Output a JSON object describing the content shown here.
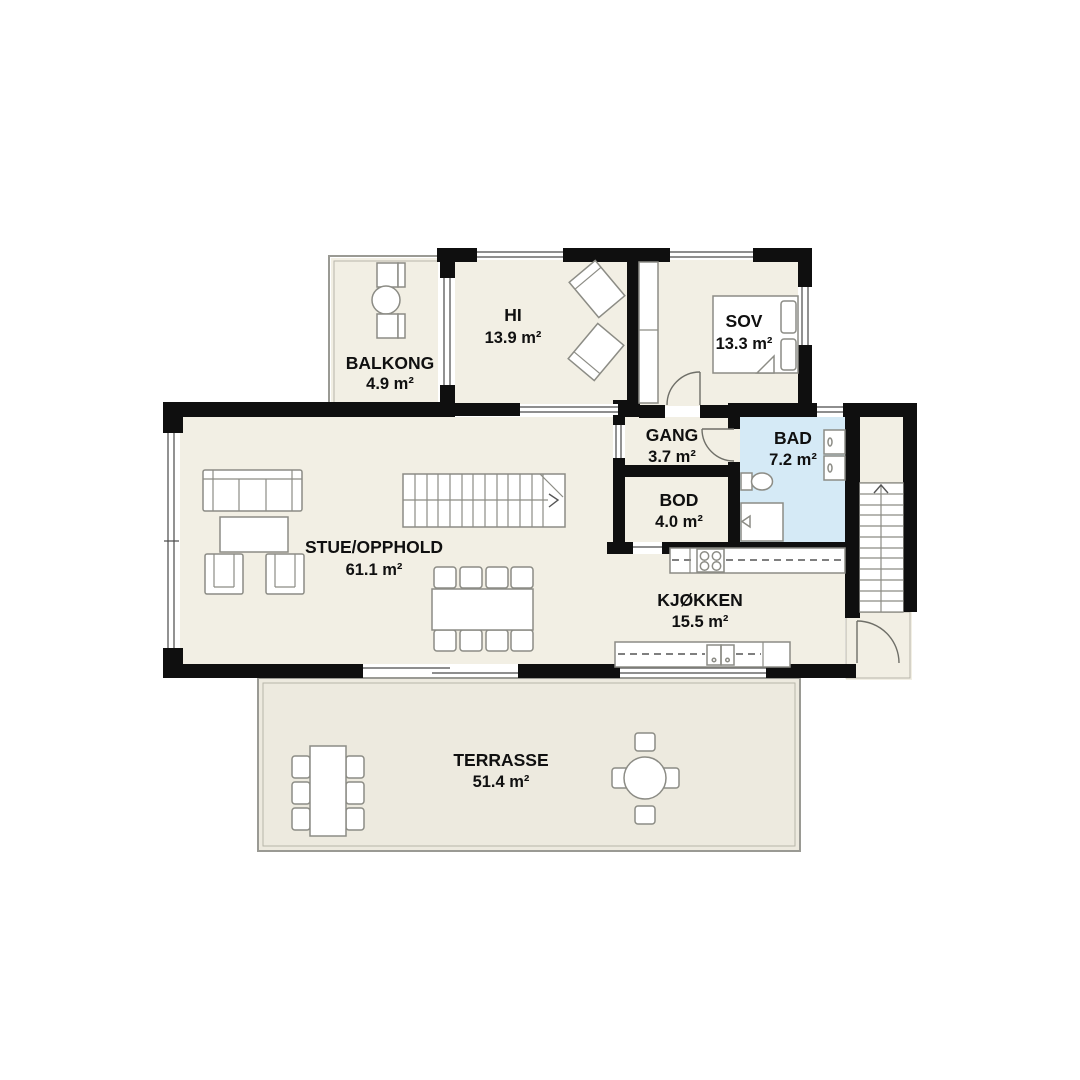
{
  "plan": {
    "type": "floor-plan",
    "language": "Norwegian",
    "rooms": [
      {
        "id": "balkong",
        "name": "BALKONG",
        "area": "4.9 m²"
      },
      {
        "id": "hi",
        "name": "HI",
        "area": "13.9 m²"
      },
      {
        "id": "sov",
        "name": "SOV",
        "area": "13.3 m²"
      },
      {
        "id": "gang",
        "name": "GANG",
        "area": "3.7 m²"
      },
      {
        "id": "bad",
        "name": "BAD",
        "area": "7.2 m²"
      },
      {
        "id": "bod",
        "name": "BOD",
        "area": "4.0 m²"
      },
      {
        "id": "stue",
        "name": "STUE/OPPHOLD",
        "area": "61.1 m²"
      },
      {
        "id": "kjokken",
        "name": "KJØKKEN",
        "area": "15.5 m²"
      },
      {
        "id": "terrasse",
        "name": "TERRASSE",
        "area": "51.4 m²"
      }
    ],
    "colors": {
      "wall": "#0f0f0f",
      "floor": "#f2efe4",
      "outdoor_floor": "#edeadf",
      "bathroom_floor": "#d5eaf6",
      "furniture_line": "#8c8c85",
      "background": "#ffffff",
      "text": "#101010"
    }
  }
}
